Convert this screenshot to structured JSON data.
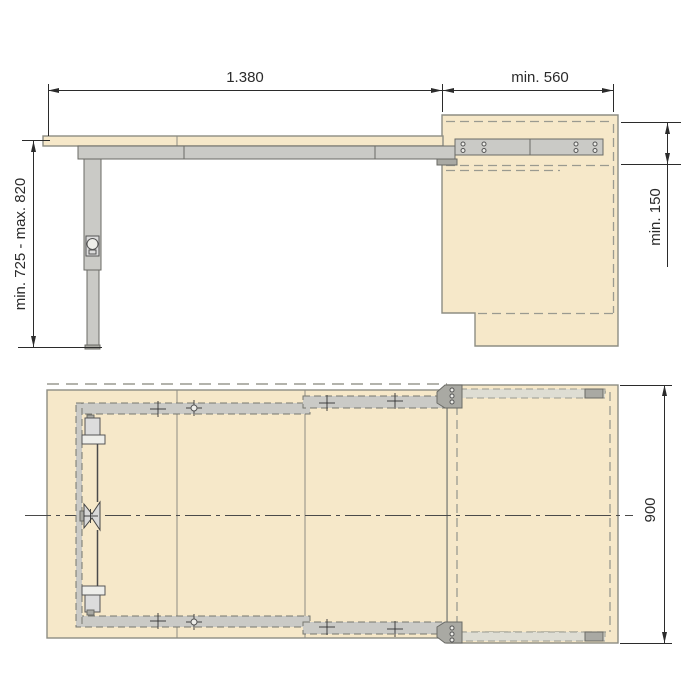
{
  "document": {
    "type": "technical-drawing",
    "subject": "height-adjustable pull-out table mechanism with cabinet, side view and plan view"
  },
  "colors": {
    "background": "#ffffff",
    "panel": "#f6e8c9",
    "panelborder": "#8d8d83",
    "metal": "#cacac6",
    "metaldark": "#a9a9a3",
    "metalborder": "#6b6b66",
    "line": "#2b2b2b",
    "dash": "#9a9a90",
    "centerline": "#4a4a4a"
  },
  "side_view": {
    "dim_length": "1.380",
    "dim_depth": "min. 560",
    "dim_height": "min. 725 - max. 820",
    "dim_clearance": "min. 150"
  },
  "plan_view": {
    "dim_width": "900"
  }
}
